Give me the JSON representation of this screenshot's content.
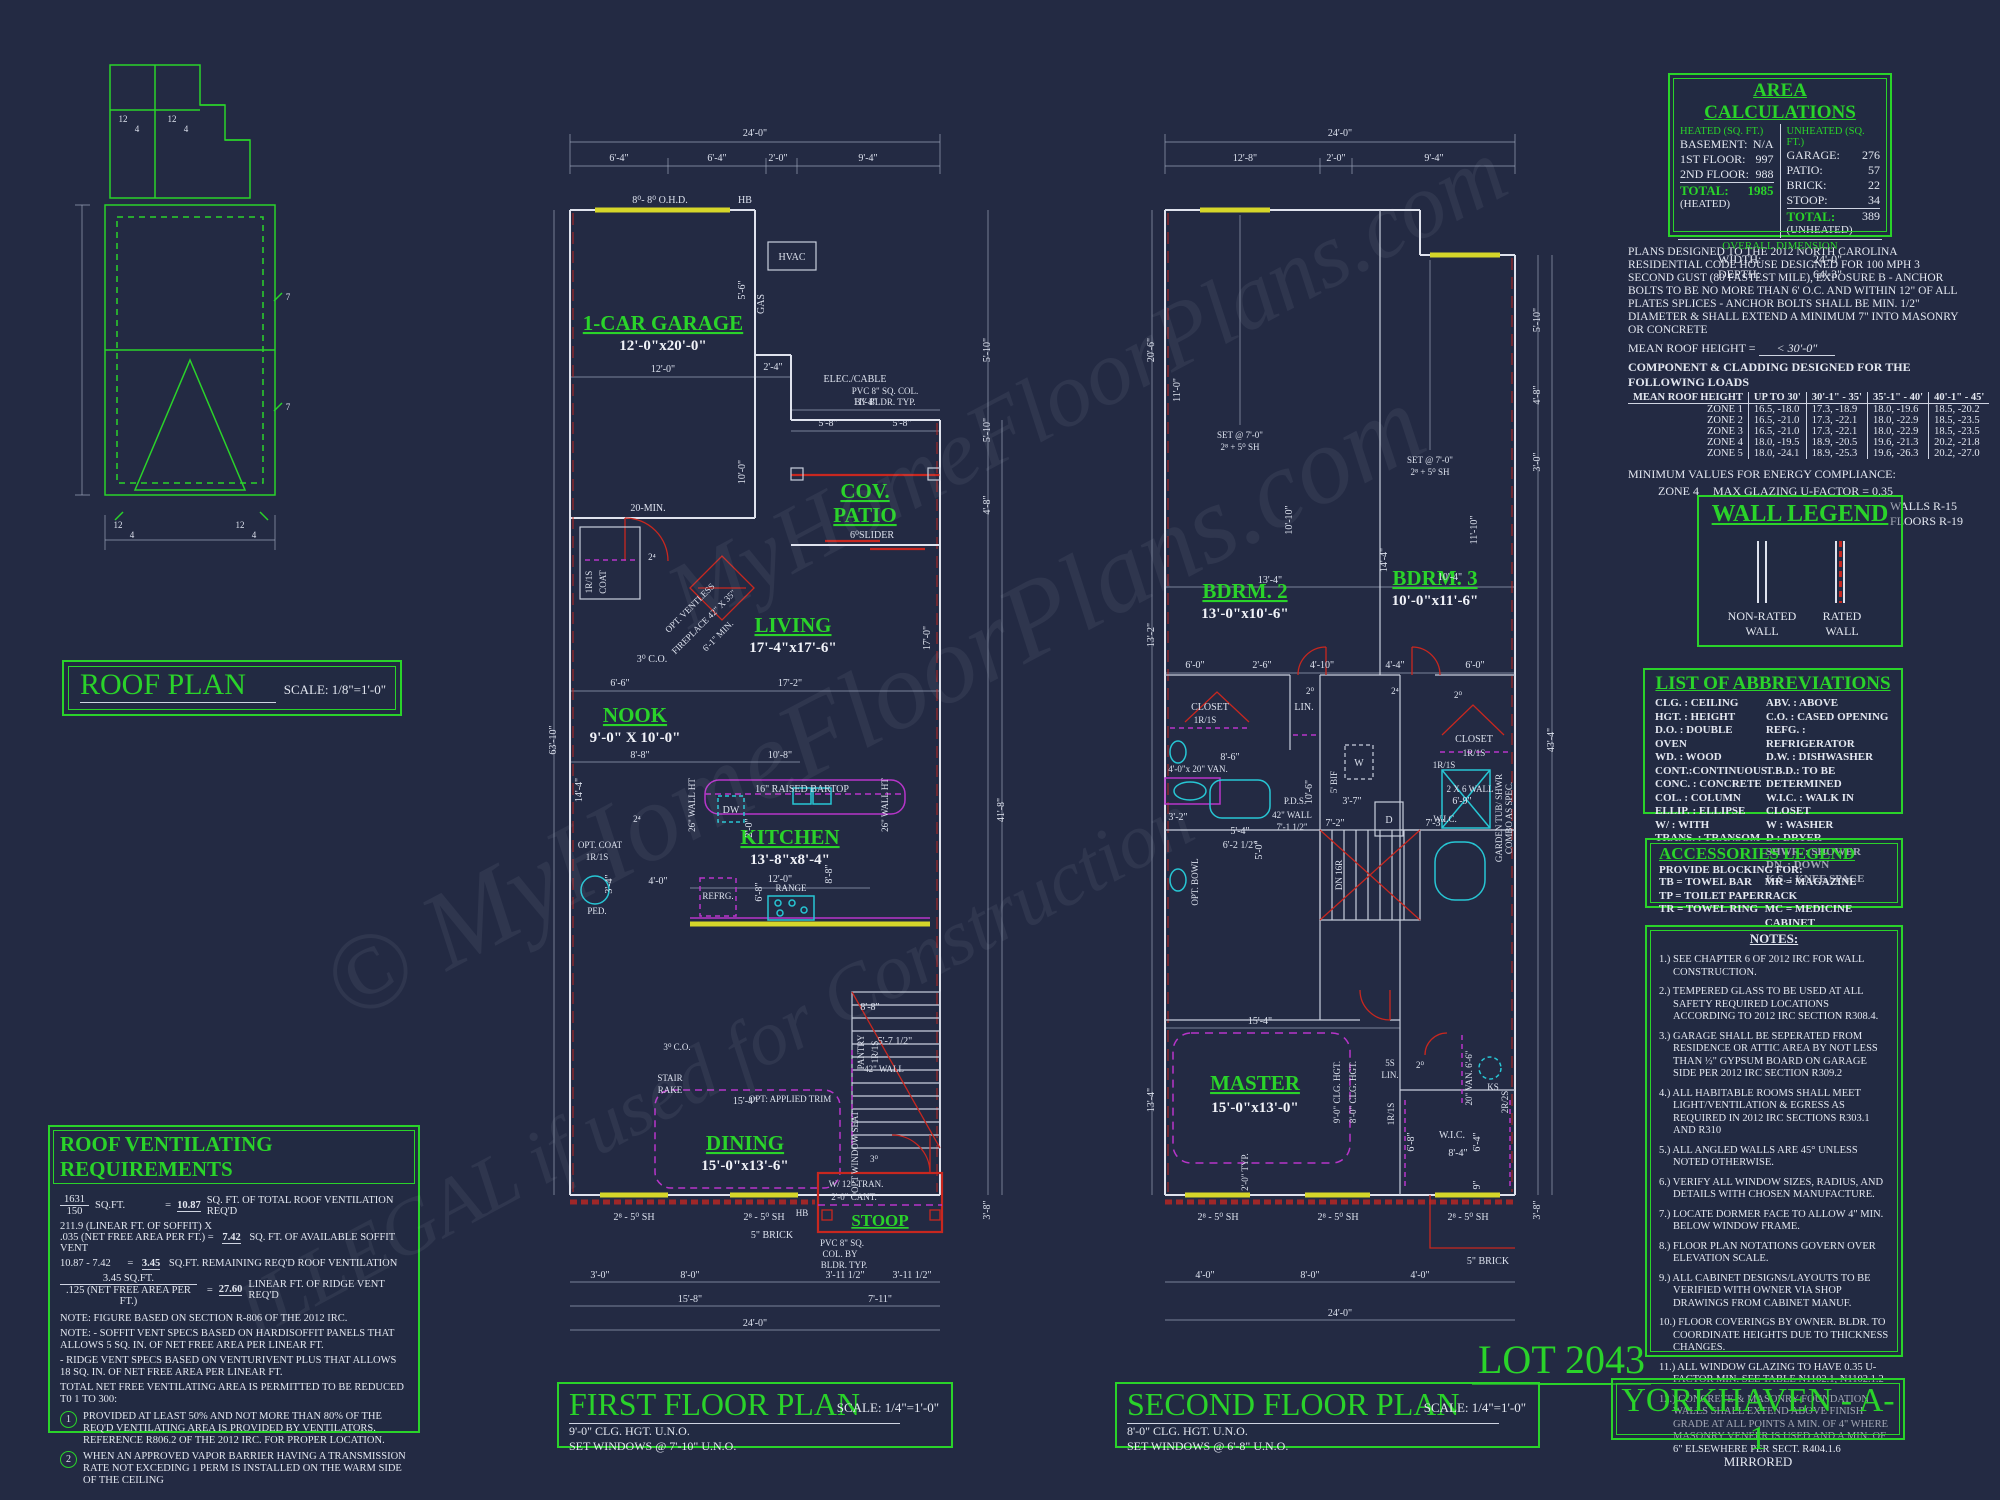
{
  "meta": {
    "sheet_name": "YORKHAVEN - A-1",
    "sheet_sub": "MIRRORED",
    "lot": "LOT 2043"
  },
  "colors": {
    "background": "#232a43",
    "accent_green": "#2ad32a",
    "line_white": "#dfe3ee",
    "wall_red": "#c8271f",
    "cabinet_magenta": "#b735c9",
    "fixture_cyan": "#27c6d4",
    "window_yellow": "#d6d62a"
  },
  "watermark": {
    "line1": "© MyHomeFloorPlans.com",
    "line2": "ILLEGAL if used for Construction",
    "line3": "MyHomeFloorPlans.com"
  },
  "roof": {
    "title": "ROOF PLAN",
    "scale": "SCALE: 1/8\"=1'-0\"",
    "pitch": [
      "12",
      "4",
      "12",
      "4",
      "12",
      "4",
      "12",
      "4",
      "7",
      "7"
    ]
  },
  "area": {
    "title": "AREA CALCULATIONS",
    "heated_header": "HEATED (SQ. FT.)",
    "heated": [
      [
        "BASEMENT:",
        "N/A"
      ],
      [
        "1ST FLOOR:",
        "997"
      ],
      [
        "2ND FLOOR:",
        "988"
      ]
    ],
    "heated_total_label": "TOTAL:",
    "heated_total_sub": "(HEATED)",
    "heated_total": "1985",
    "unheated_header": "UNHEATED (SQ. FT.)",
    "unheated": [
      [
        "GARAGE:",
        "276"
      ],
      [
        "PATIO:",
        "57"
      ],
      [
        "BRICK:",
        "22"
      ],
      [
        "STOOP:",
        "34"
      ]
    ],
    "unheated_total_label": "TOTAL:",
    "unheated_total_sub": "(UNHEATED)",
    "unheated_total": "389",
    "overall_header": "OVERALL DIMENSION",
    "width_label": "WIDTH:",
    "width": "24'-0\"",
    "depth_label": "DEPTH:",
    "depth": "64'-3\""
  },
  "code": {
    "paragraph": "PLANS DESIGNED TO THE 2012 NORTH CAROLINA RESIDENTIAL CODE HOUSE DESIGNED FOR 100 MPH 3 SECOND GUST (80 FASTEST MILE), EXPOSURE B  - ANCHOR BOLTS TO BE NO MORE THAN 6' O.C. AND WITHIN 12\" OF ALL PLATES SPLICES - ANCHOR BOLTS SHALL BE MIN. 1/2\" DIAMETER & SHALL EXTEND A MINIMUM 7\" INTO MASONRY OR CONCRETE",
    "mean_roof_label": "MEAN ROOF HEIGHT =",
    "mean_roof_value": "< 30'-0\"",
    "clad_title": "COMPONENT & CLADDING DESIGNED FOR THE FOLLOWING LOADS",
    "headers": [
      "MEAN ROOF HEIGHT",
      "UP TO 30'",
      "30'-1\" - 35'",
      "35'-1\" - 40'",
      "40'-1\" - 45'"
    ],
    "rows": [
      [
        "ZONE 1",
        "16.5, -18.0",
        "17.3, -18.9",
        "18.0, -19.6",
        "18.5, -20.2"
      ],
      [
        "ZONE 2",
        "16.5, -21.0",
        "17.3, -22.1",
        "18.0, -22.9",
        "18.5, -23.5"
      ],
      [
        "ZONE 3",
        "16.5, -21.0",
        "17.3, -22.1",
        "18.0, -22.9",
        "18.5, -23.5"
      ],
      [
        "ZONE 4",
        "18.0, -19.5",
        "18.9, -20.5",
        "19.6, -21.3",
        "20.2, -21.8"
      ],
      [
        "ZONE 5",
        "18.0, -24.1",
        "18.9, -25.3",
        "19.6, -26.3",
        "20.2, -27.0"
      ]
    ],
    "energy_line": "MINIMUM VALUES FOR ENERGY COMPLIANCE:",
    "energy_zone": "ZONE 4",
    "energy_factor": "MAX GLAZING U-FACTOR = 0.35",
    "energy_r": [
      "CEILING R-30",
      "WALLS R-15",
      "FLOORS R-19"
    ]
  },
  "wall_legend": {
    "title": "WALL LEGEND",
    "non_rated": "NON-RATED WALL",
    "rated": "RATED WALL"
  },
  "abbr": {
    "title": "LIST OF ABBREVIATIONS",
    "col1": [
      "CLG. : CEILING",
      "HGT. : HEIGHT",
      "D.O. : DOUBLE OVEN",
      "WD. : WOOD",
      "CONT.:CONTINUOUS",
      "CONC. : CONCRETE",
      "COL. : COLUMN",
      "ELLIP. : ELLIPSE",
      "W/ : WITH",
      "TRANS. : TRANSOM"
    ],
    "col2": [
      "ABV. : ABOVE",
      "C.O. : CASED OPENING",
      "REFG. : REFRIGERATOR",
      "D.W. : DISHWASHER",
      "T.B.D.: TO BE DETERMINED",
      "W.I.C. : WALK IN CLOSET",
      "W : WASHER",
      "D : DRYER",
      "SHWR. : SHOWER",
      "DN. : DOWN",
      "K.S. : KNEE SPACE"
    ]
  },
  "acc": {
    "title": "ACCESSORIES LEGEND",
    "provide": "PROVIDE BLOCKING FOR:",
    "col1": [
      "TB = TOWEL BAR",
      "TP = TOILET PAPER",
      "TR = TOWEL RING"
    ],
    "col2": [
      "MR = MAGAZINE RACK",
      "MC = MEDICINE CABINET"
    ]
  },
  "notes": {
    "title": "NOTES:",
    "items": [
      "1.) SEE CHAPTER 6 OF 2012 IRC FOR WALL CONSTRUCTION.",
      "2.) TEMPERED GLASS TO BE USED AT ALL SAFETY REQUIRED LOCATIONS ACCORDING TO 2012 IRC SECTION R308.4.",
      "3.) GARAGE SHALL BE SEPERATED FROM RESIDENCE OR ATTIC AREA BY NOT LESS THAN ½\" GYPSUM BOARD ON GARAGE SIDE PER 2012 IRC SECTION R309.2",
      "4.) ALL HABITABLE ROOMS SHALL MEET LIGHT/VENTILATION & EGRESS AS REQUIRED IN 2012 IRC SECTIONS R303.1 AND R310",
      "5.) ALL ANGLED WALLS ARE 45° UNLESS NOTED OTHERWISE.",
      "6.) VERIFY ALL WINDOW SIZES, RADIUS, AND DETAILS WITH CHOSEN MANUFACTURE.",
      "7.) LOCATE DORMER FACE TO ALLOW 4\" MIN. BELOW WINDOW FRAME.",
      "8.) FLOOR PLAN NOTATIONS GOVERN OVER ELEVATION SCALE.",
      "9.) ALL CABINET DESIGNS/LAYOUTS TO BE VERIFIED WITH OWNER VIA SHOP DRAWINGS FROM CABINET MANUF.",
      "10.) FLOOR COVERINGS BY OWNER. BLDR. TO COORDINATE HEIGHTS DUE TO THICKNESS CHANGES.",
      "11.) ALL WINDOW GLAZING TO HAVE 0.35 U-FACTOR MIN.  SEE TABLE N1102.1, N1102.1.2",
      "12.) CONCRETE & MASONRY FOUNDATION WALLS SHALL EXTEND ABOVE FINISH GRADE AT ALL POINTS A MIN. OF 4\" WHERE MASONRY VENEER IS USED AND A MIN. OF 6\" ELSEWHERE PER SECT. R404.1.6"
    ]
  },
  "vent": {
    "title": "ROOF VENTILATING REQUIREMENTS",
    "r1n": "1631",
    "r1d": "150",
    "r1u": "SQ.FT.",
    "r1eq": "=",
    "r1v": "10.87",
    "r1t": "SQ. FT. OF TOTAL ROOF VENTILATION REQ'D",
    "r2a": "211.9 (LINEAR FT. OF SOFFIT) X",
    "r2b": ".035 (NET FREE AREA PER FT.) =",
    "r2v": "7.42",
    "r2t": "SQ. FT. OF AVAILABLE SOFFIT VENT",
    "r3a": "10.87 - 7.42",
    "r3eq": "=",
    "r3v": "3.45",
    "r3t": "SQ.FT. REMAINING REQ'D ROOF VENTILATION",
    "r4n": "3.45",
    "r4u": "SQ.FT.",
    "r4d": ".125 (NET FREE AREA PER FT.)",
    "r4eq": "=",
    "r4v": "27.60",
    "r4t": "LINEAR FT. OF RIDGE VENT REQ'D",
    "notes": [
      "NOTE: FIGURE BASED ON SECTION R-806 OF THE 2012 IRC.",
      "NOTE: - SOFFIT VENT SPECS BASED ON HARDISOFFIT PANELS THAT ALLOWS 5 SQ. IN. OF NET FREE AREA PER LINEAR FT.",
      "- RIDGE VENT SPECS BASED ON VENTURIVENT PLUS THAT ALLOWS 18 SQ. IN. OF NET FREE AREA PER LINEAR FT.",
      "TOTAL NET FREE VENTILATING AREA IS PERMITTED TO BE REDUCED T0 1 TO 300:"
    ],
    "items": [
      {
        "n": "1",
        "t": "PROVIDED AT LEAST 50% AND NOT MORE THAN 80% OF THE REQ'D VENTILATING AREA IS PROVIDED BY VENTILATORS.  REFERENCE R806.2  OF THE 2012 IRC. FOR PROPER LOCATION."
      },
      {
        "n": "2",
        "t": "WHEN AN APPROVED VAPOR BARRIER HAVING A TRANSMISSION RATE NOT EXCEDING 1 PERM IS INSTALLED ON THE WARM SIDE OF THE CEILING"
      }
    ]
  },
  "ff_title": {
    "name": "FIRST FLOOR PLAN",
    "scale": "SCALE: 1/4\"=1'-0\"",
    "l1": "9'-0\" CLG. HGT. U.N.O.",
    "l2": "SET WINDOWS @ 7'-10\" U.N.O."
  },
  "sf_title": {
    "name": "SECOND FLOOR PLAN",
    "scale": "SCALE: 1/4\"=1'-0\"",
    "l1": "8'-0\" CLG. HGT. U.N.O.",
    "l2": "SET WINDOWS @ 6'-8\" U.N.O."
  },
  "ff": {
    "rooms": {
      "garage": "1-CAR GARAGE",
      "garage_size": "12'-0\"x20'-0\"",
      "patio1": "COV.",
      "patio2": "PATIO",
      "living": "LIVING",
      "living_size": "17'-4\"x17'-6\"",
      "nook": "NOOK",
      "nook_size": "9'-0\" X 10'-0\"",
      "kitchen": "KITCHEN",
      "kitchen_size": "13'-8\"x8'-4\"",
      "dining": "DINING",
      "dining_size": "15'-0\"x13'-6\"",
      "stoop": "STOOP"
    },
    "ann": [
      "8⁰- 8⁰ O.H.D.",
      "HB",
      "HVAC",
      "GAS",
      "ELEC./CABLE",
      "PVC 8\" SQ. COL.",
      "BY BLDR. TYP.",
      "20-MIN.",
      "6⁰SLIDER",
      "1R/1S",
      "COAT",
      "2⁴",
      "3⁰ C.O.",
      "OPT. VENTLESS",
      "FIREPLACE 42\" X 35\"",
      "6'-1\" MIN.",
      "16\" RAISED BARTOP",
      "DW",
      "26\" WALL HT",
      "26\" WALL HT",
      "REFRG.",
      "RANGE",
      "OPT. COAT",
      "1R/1S",
      "PED.",
      "PANTRY",
      "1R/1S",
      "STAIR",
      "RAKE",
      "42\" WALL",
      "OPT: APPLIED TRIM",
      "OPT WINDOW SEAT",
      "2⁸ - 5⁰ SH",
      "2⁸ - 5⁰ SH",
      "5\" BRICK",
      "HB",
      "W/ 12\" TRAN.",
      "2'-0\" CANT.",
      "3⁰",
      "PVC 8\" SQ.",
      "COL. BY",
      "BLDR. TYP.",
      "3⁰ C.O.",
      "2⁴"
    ],
    "dims": [
      "24'-0\"",
      "6'-4\"",
      "6'-4\"",
      "2'-0\"",
      "9'-4\"",
      "12'-0\"",
      "2'-4\"",
      "11'-4\"",
      "5'-8\"",
      "5'-8\"",
      "10'-0\"",
      "5'-6\"",
      "6'-6\"",
      "17'-2\"",
      "17'-0\"",
      "8'-8\"",
      "10'-8\"",
      "14'-4\"",
      "12'-0\"",
      "2'-0\"",
      "6'-8\"",
      "8'-8\"",
      "4'-0\"",
      "3'-4\"",
      "8'-8\"",
      "5'-7 1/2\"",
      "15'-4\"",
      "63'-10\"",
      "5'-10\"",
      "5'-10\"",
      "4'-8\"",
      "41'-8\"",
      "3'-8\"",
      "3'-0\"",
      "8'-0\"",
      "3'-11 1/2\"",
      "3'-11 1/2\"",
      "15'-8\"",
      "7'-11\"",
      "24'-0\""
    ]
  },
  "sf": {
    "rooms": {
      "b2": "BDRM. 2",
      "b2_size": "13'-0\"x10'-6\"",
      "b3": "BDRM. 3",
      "b3_size": "10'-0\"x11'-6\"",
      "master": "MASTER",
      "master_size": "15'-0\"x13'-0\""
    },
    "ann": [
      "SET @ 7'-0\"",
      "2⁸ + 5⁰ SH",
      "SET @ 7'-0\"",
      "2⁸ + 5⁰ SH",
      "CLOSET",
      "1R/1S",
      "LIN.",
      "CLOSET",
      "1R/1S",
      "4'-0\"x 20\" VAN.",
      "2 X 6 WALL",
      "1R/1S",
      "W",
      "D",
      "5' BIF",
      "P.D.S.",
      "42\" WALL",
      "7'-1 1/2\"",
      "DN 16R",
      "GARDEN TUB/ SHWR",
      "COMBO AS SPEC.",
      "OPT. BOWL",
      "5S",
      "LIN.",
      "KS",
      "20\" VAN. 6'-6\"",
      "1R/1S",
      "2R/2S",
      "W.I.C.",
      "9'-0\" CLG. HGT.",
      "8'-0\" CLG. HGT.",
      "2'-0\" TYP.",
      "2⁸ - 5⁰ SH",
      "2⁸ - 5⁰ SH",
      "2⁸ - 5⁰ SH",
      "5\" BRICK",
      "2⁰",
      "2⁰",
      "2⁴",
      "2⁰",
      "W.I.C."
    ],
    "dims": [
      "24'-0\"",
      "12'-8\"",
      "2'-0\"",
      "9'-4\"",
      "13'-4\"",
      "10'-4\"",
      "11'-0\"",
      "14'-4\"",
      "11'-10\"",
      "10'-10\"",
      "6'-0\"",
      "2'-6\"",
      "4'-10\"",
      "4'-4\"",
      "6'-0\"",
      "13'-2\"",
      "8'-6\"",
      "3'-2\"",
      "5'-4\"",
      "10'-6\"",
      "5'-0\"",
      "6'-2 1/2\"",
      "7'-2\"",
      "7'-3\"",
      "3'-7\"",
      "6'-9\"",
      "8'-4\"",
      "6'-4\"",
      "9\"",
      "15'-4\"",
      "13'-4\"",
      "20'-6\"",
      "43'-4\"",
      "3'-8\"",
      "5'-10\"",
      "4'-8\"",
      "3'-0\"",
      "4'-0\"",
      "8'-0\"",
      "4'-0\"",
      "24'-0\"",
      "6'-8\""
    ]
  }
}
